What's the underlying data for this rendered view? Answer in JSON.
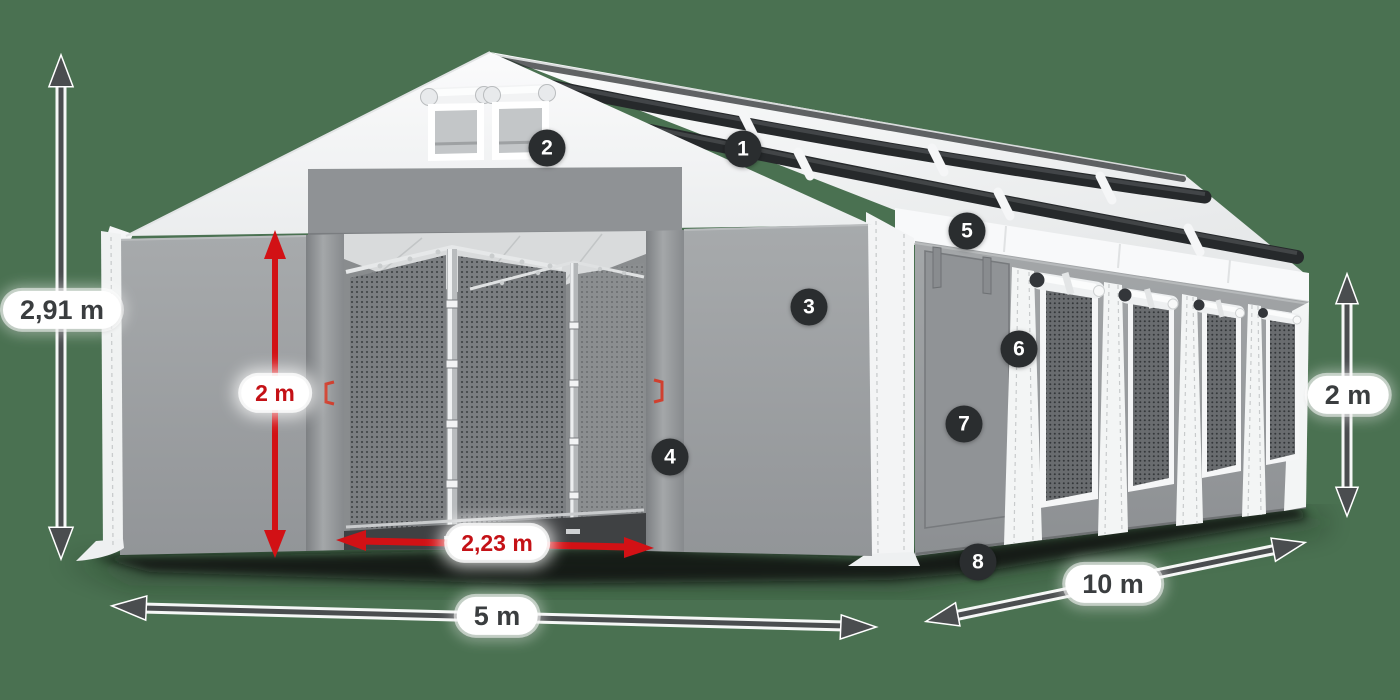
{
  "scene": {
    "description": "Storage tent product diagram with numbered feature callouts and dimensions",
    "background_color": "#4a7151",
    "accent_red": "#d21115",
    "arrow_dark": "#4a4d4f",
    "badge_color": "#2a2d2f"
  },
  "dimensions": {
    "total_height": "2,91 m",
    "entrance_height": "2 m",
    "entrance_width": "2,23 m",
    "width": "5 m",
    "length": "10 m",
    "side_height": "2 m"
  },
  "callouts": [
    {
      "number": "1"
    },
    {
      "number": "2"
    },
    {
      "number": "3"
    },
    {
      "number": "4"
    },
    {
      "number": "5"
    },
    {
      "number": "6"
    },
    {
      "number": "7"
    },
    {
      "number": "8"
    }
  ]
}
